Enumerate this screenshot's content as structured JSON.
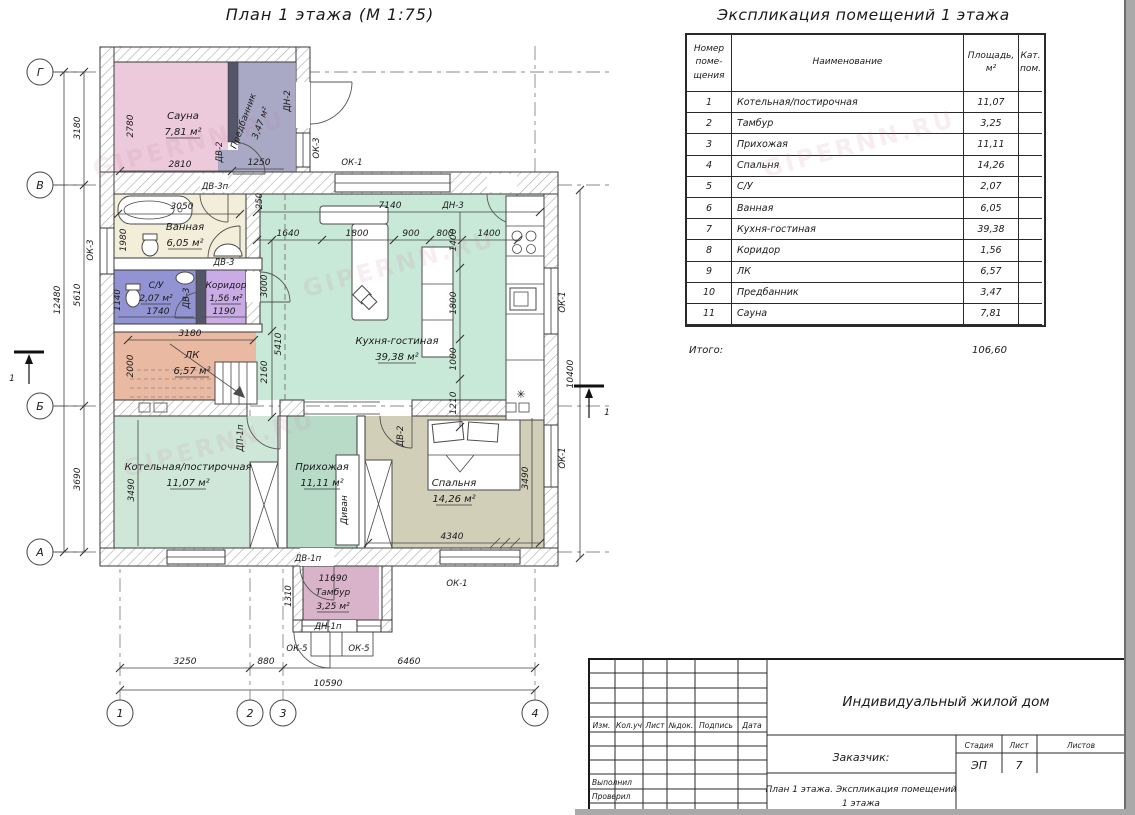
{
  "watermark": "GIPERNN.RU",
  "plan": {
    "title": "План 1 этажа (М 1:75)",
    "axes": {
      "h": [
        "Г",
        "В",
        "Б",
        "А"
      ],
      "v": [
        "1",
        "2",
        "3",
        "4"
      ],
      "section": "1"
    },
    "rooms": {
      "sauna": {
        "name": "Сауна",
        "area": "7,81 м²"
      },
      "predbannik": {
        "name": "Предбанник",
        "area": "3,47 м²"
      },
      "vannaya": {
        "name": "Ванная",
        "area": "6,05 м²"
      },
      "su": {
        "name": "С/У",
        "area": "2,07 м²"
      },
      "koridor": {
        "name": "Коридор",
        "area": "1,56 м²"
      },
      "lk": {
        "name": "ЛК",
        "area": "6,57 м²"
      },
      "kotelnaya": {
        "name": "Котельная/постирочная",
        "area": "11,07 м²"
      },
      "prihozhaya": {
        "name": "Прихожая",
        "area": "11,11 м²"
      },
      "spalnya": {
        "name": "Спальня",
        "area": "14,26 м²"
      },
      "tambur": {
        "name": "Тамбур",
        "area": "3,25 м²"
      },
      "kuhnya": {
        "name": "Кухня-гостиная",
        "area": "39,38 м²"
      },
      "divan": "Диван"
    },
    "marks": {
      "ok1": "ОК-1",
      "ok3": "ОК-3",
      "ok5": "ОК-5",
      "dn1p": "ДН-1п",
      "dn2": "ДН-2",
      "dn3": "ДН-3",
      "dv1p": "ДВ-1п",
      "dv2": "ДВ-2",
      "dv3": "ДВ-3",
      "dv3p": "ДВ-3п",
      "dp1p": "ДП-1п"
    },
    "dims": {
      "left": [
        "3180",
        "5610",
        "3690"
      ],
      "left_total": "12480",
      "bottom": [
        "3250",
        "880",
        "6460"
      ],
      "bottom_total": "10590",
      "right_total": "10400",
      "sauna_w": "2810",
      "sauna_h": "2780",
      "predbannik_w": "1250",
      "vannaya_w": "3050",
      "vannaya_h": "1980",
      "su_w": "1740",
      "su_h": "1140",
      "koridor_w": "1190",
      "lk_w": "3180",
      "lk_h": "2000",
      "kotelnaya_h": "3490",
      "kitchen_total": "7140",
      "kitchen_chain": [
        "1640",
        "1800",
        "900",
        "800",
        "1400"
      ],
      "k250": "250",
      "k3000": "3000",
      "k2160": "2160",
      "kitchen_right": [
        "1400",
        "1800",
        "1000",
        "1210"
      ],
      "k5410": "5410",
      "spalnya_w": "4340",
      "spalnya_h": "3490",
      "tambur_w": "11690",
      "tambur_h": "1310"
    },
    "icons": {
      "snowflake": "✳"
    }
  },
  "table": {
    "title": "Экспликация помещений 1 этажа",
    "col_num": "Номер\nпоме-\nщения",
    "col_name": "Наименование",
    "col_area": "Площадь,\nм²",
    "col_cat": "Кат.\nпом.",
    "rows": [
      {
        "num": "1",
        "name": "Котельная/постирочная",
        "area": "11,07"
      },
      {
        "num": "2",
        "name": "Тамбур",
        "area": "3,25"
      },
      {
        "num": "3",
        "name": "Прихожая",
        "area": "11,11"
      },
      {
        "num": "4",
        "name": "Спальня",
        "area": "14,26"
      },
      {
        "num": "5",
        "name": "С/У",
        "area": "2,07"
      },
      {
        "num": "6",
        "name": "Ванная",
        "area": "6,05"
      },
      {
        "num": "7",
        "name": "Кухня-гостиная",
        "area": "39,38"
      },
      {
        "num": "8",
        "name": "Коридор",
        "area": "1,56"
      },
      {
        "num": "9",
        "name": "ЛК",
        "area": "6,57"
      },
      {
        "num": "10",
        "name": "Предбанник",
        "area": "3,47"
      },
      {
        "num": "11",
        "name": "Сауна",
        "area": "7,81"
      }
    ],
    "total_label": "Итого:",
    "total": "106,60"
  },
  "titleblock": {
    "cols": [
      "Изм.",
      "Кол.уч",
      "Лист",
      "№док.",
      "Подпись",
      "Дата"
    ],
    "executed": "Выполнил",
    "checked": "Проверил",
    "project": "Индивидуальный жилой дом",
    "client": "Заказчик:",
    "stage_label": "Стадия",
    "sheet_label": "Лист",
    "sheets_label": "Листов",
    "stage": "ЭП",
    "sheet": "7",
    "doc_line1": "План 1 этажа. Экспликация помещений",
    "doc_line2": "1 этажа"
  }
}
